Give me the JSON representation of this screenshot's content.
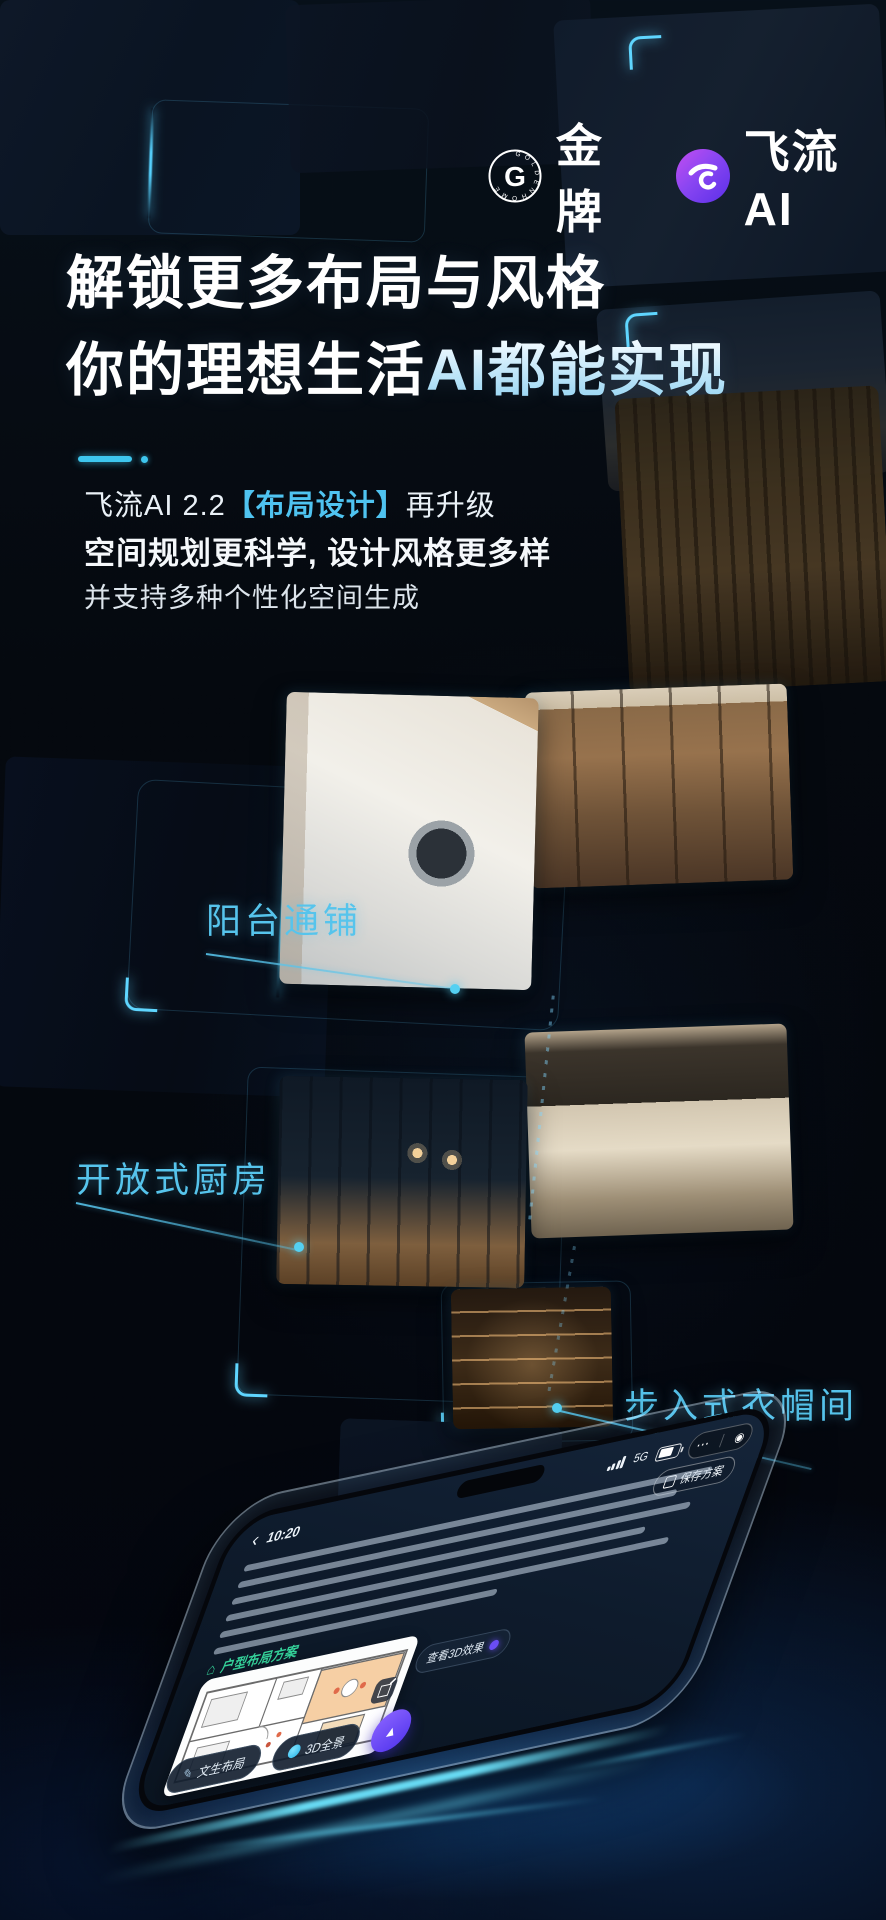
{
  "poster": {
    "brand": {
      "goldmedal": {
        "monogram": "G",
        "ring_text": "GOLDENHOME",
        "name": "金牌"
      },
      "feiliu": {
        "name": "飞流AI"
      }
    },
    "headline": {
      "line1": "解锁更多布局与风格",
      "line2_plain": "你的理想生活",
      "line2_accent": "AI都能实现"
    },
    "intro": {
      "line1_prefix": "飞流AI 2.2",
      "line1_accent": "【布局设计】",
      "line1_suffix": "再升级",
      "line2": "空间规划更科学, 设计风格更多样",
      "line3": "并支持多种个性化空间生成"
    },
    "features": [
      {
        "id": "balcony",
        "label": "阳台通铺"
      },
      {
        "id": "kitchen",
        "label": "开放式厨房"
      },
      {
        "id": "closet",
        "label": "步入式衣帽间"
      }
    ],
    "phone": {
      "status": {
        "time": "10:20",
        "network": "5G"
      },
      "save_pill": "保存方案",
      "result_badge": "户型布局方案",
      "view_3d_pill": "查看3D效果",
      "chips": [
        {
          "label": "文生布局"
        },
        {
          "label": "3D全景"
        }
      ]
    },
    "icons": {
      "back": "‹",
      "more": "⋯",
      "capsule_dot": "◉",
      "pen": "✎",
      "send": "▲",
      "house": "⌂"
    },
    "colors": {
      "accent_cyan": "#4fc3f0",
      "accent_purple": "#6a4df5",
      "badge_green": "#35d29a",
      "background": "#060b14"
    }
  }
}
